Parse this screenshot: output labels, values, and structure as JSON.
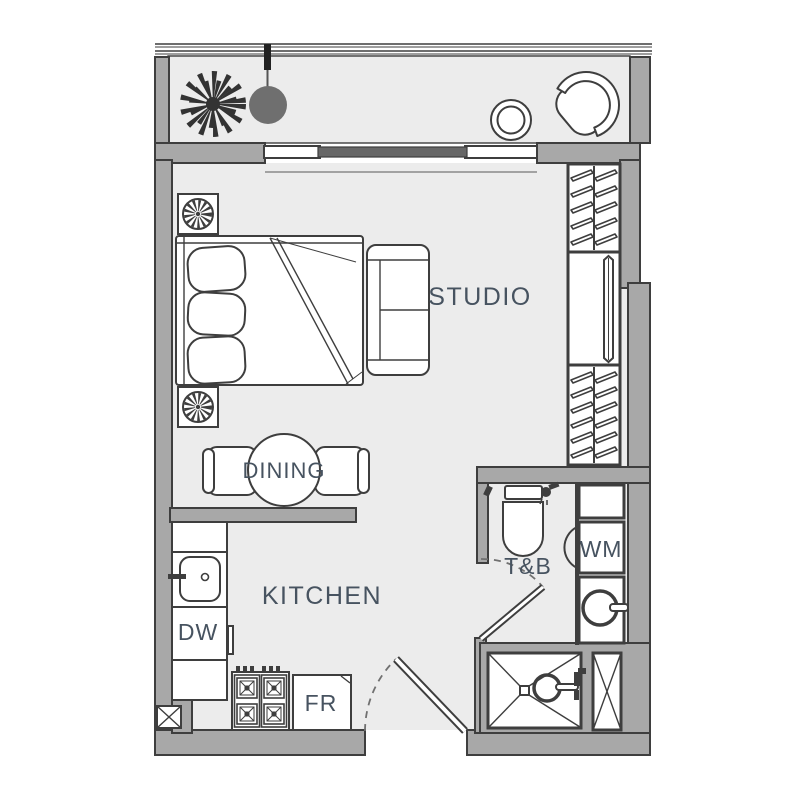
{
  "title": "Studio unit floor plan",
  "rooms": {
    "studio": {
      "label": "STUDIO"
    },
    "dining": {
      "label": "DINING"
    },
    "kitchen": {
      "label": "KITCHEN"
    },
    "toilet_bath": {
      "label": "T&B"
    }
  },
  "appliances": {
    "washing_machine": {
      "label": "WM"
    },
    "dishwasher": {
      "label": "DW"
    },
    "refrigerator": {
      "label": "FR"
    }
  },
  "features": [
    "balcony-railing",
    "potted-plant",
    "pendant-lamp",
    "round-stool",
    "lounge-chair",
    "sliding-glass-door",
    "nightstand-plant",
    "double-bed",
    "sofa",
    "wardrobe-hangers",
    "wardrobe-mirror",
    "dining-table",
    "dining-chairs",
    "kitchen-counter",
    "sink",
    "stove-4-burner",
    "service-shaft",
    "entrance-door",
    "toilet",
    "shower-head",
    "bathroom-door",
    "washer-drum",
    "shower-pan",
    "duct-shaft"
  ],
  "colors": {
    "wall": "#a8a8a8",
    "outline": "#3e3e3e",
    "room_fill": "#ececec",
    "furniture_fill": "#ffffff",
    "label_text": "#475360",
    "pendant": "#6f6f6f",
    "sliding_panel": "#676767",
    "plant": "#333333"
  }
}
